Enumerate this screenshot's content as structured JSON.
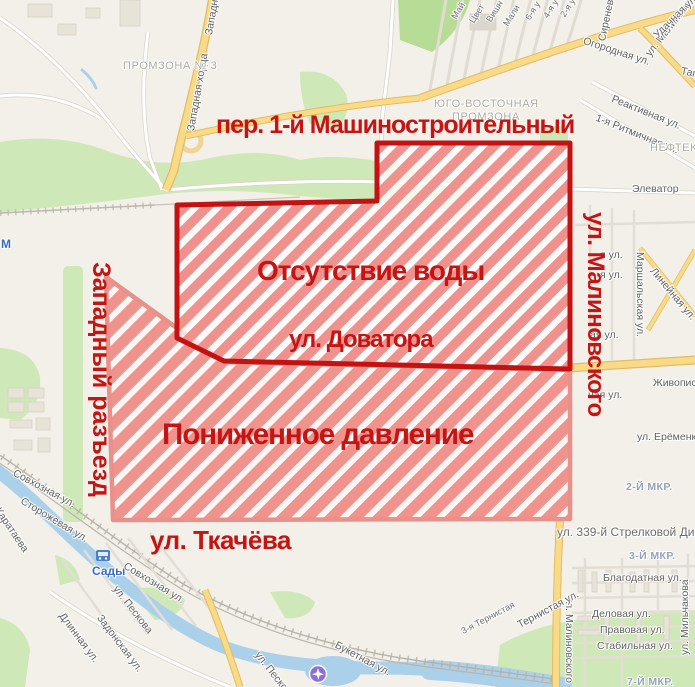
{
  "app": {
    "title": "Карта отключений воды"
  },
  "overlay": {
    "label_color": "#c51414",
    "hatch_color": "#ef928e",
    "zones": [
      {
        "name": "low-pressure-zone",
        "title": "Пониженное давление",
        "points": "106,277 224,362 570,370 570,519 113,520",
        "base_fill": "rgba(255,247,246,0.80)",
        "pattern": "hatchB",
        "border_color": "#e8908a",
        "border_width": 4.5
      },
      {
        "name": "no-water-zone",
        "title": "Отсутствие воды",
        "points": "177,205 377,201 377,143 570,143 570,369 224,361 177,338",
        "base_fill": "rgba(255,255,255,0.74)",
        "pattern": "hatchA",
        "border_color": "#c41212",
        "border_width": 5
      }
    ],
    "labels": [
      {
        "name": "overlay-street-mashinostroitelny",
        "text": "пер. 1-й Машиностроительный",
        "x": 216,
        "y": 112,
        "size": 25,
        "rot": 0,
        "ls": -1
      },
      {
        "name": "overlay-street-malinovskogo",
        "text": "ул. Малиновского",
        "x": 608,
        "y": 212,
        "size": 24,
        "rot": 90,
        "ls": -0.5
      },
      {
        "name": "zone-label-no-water",
        "text": "Отсутствие воды",
        "x": 257,
        "y": 256,
        "size": 28,
        "rot": 0,
        "ls": -1
      },
      {
        "name": "overlay-street-dovatora",
        "text": "ул. Доватора",
        "x": 289,
        "y": 327,
        "size": 24,
        "rot": 0,
        "ls": -1
      },
      {
        "name": "zone-label-low-pressure",
        "text": "Пониженное давление",
        "x": 162,
        "y": 420,
        "size": 29.5,
        "rot": 0,
        "ls": -1
      },
      {
        "name": "overlay-street-zapadny-razezd",
        "text": "Западный разъезд",
        "x": 114,
        "y": 262,
        "size": 25,
        "rot": 90,
        "ls": 0
      },
      {
        "name": "overlay-street-tkacheva",
        "text": "ул. Ткачёва",
        "x": 150,
        "y": 527,
        "size": 26,
        "rot": 0,
        "ls": -0.5
      }
    ]
  },
  "map_labels": [
    {
      "text": "Западная хорда",
      "x": 186,
      "y": 130,
      "rot": -80,
      "cls": "street"
    },
    {
      "text": "Западная хорда",
      "x": 204,
      "y": 34,
      "rot": -80,
      "cls": "street"
    },
    {
      "text": "ПРОМЗОНА № 3",
      "x": 123,
      "y": 60,
      "rot": 0,
      "cls": "area"
    },
    {
      "text": "ЮГО-ВОСТОЧНАЯ",
      "x": 434,
      "y": 98,
      "rot": 0,
      "cls": "area"
    },
    {
      "text": "ПРОМЗОНА",
      "x": 452,
      "y": 111,
      "rot": 0,
      "cls": "area"
    },
    {
      "text": "Огородная ул.",
      "x": 585,
      "y": 36,
      "rot": 18,
      "cls": "street"
    },
    {
      "text": "ул. Малиновского",
      "x": 644,
      "y": 52,
      "rot": -52,
      "cls": "street"
    },
    {
      "text": "Сиреневая ул.",
      "x": 597,
      "y": 40,
      "rot": -78,
      "cls": "street"
    },
    {
      "text": "Удачная ул.",
      "x": 652,
      "y": 33,
      "rot": -45,
      "cls": "street"
    },
    {
      "text": "Таг",
      "x": 682,
      "y": 66,
      "rot": 12,
      "cls": "street"
    },
    {
      "text": "Реактивная ул.",
      "x": 614,
      "y": 94,
      "rot": 22,
      "cls": "street"
    },
    {
      "text": "1-я Ритмичная ул.",
      "x": 598,
      "y": 113,
      "rot": 22,
      "cls": "street"
    },
    {
      "text": "Май",
      "x": 450,
      "y": 16,
      "rot": -58,
      "cls": "small"
    },
    {
      "text": "Цвет",
      "x": 468,
      "y": 20,
      "rot": -58,
      "cls": "small"
    },
    {
      "text": "Вишн",
      "x": 485,
      "y": 19,
      "rot": -58,
      "cls": "small"
    },
    {
      "text": "Мали",
      "x": 502,
      "y": 23,
      "rot": -58,
      "cls": "small"
    },
    {
      "text": "6-я у",
      "x": 524,
      "y": 17,
      "rot": -58,
      "cls": "small"
    },
    {
      "text": "4-я у",
      "x": 542,
      "y": 15,
      "rot": -58,
      "cls": "small"
    },
    {
      "text": "2-я у",
      "x": 559,
      "y": 14,
      "rot": -58,
      "cls": "small"
    },
    {
      "text": "НЕФТЕКАЧ",
      "x": 650,
      "y": 142,
      "rot": 0,
      "cls": "area"
    },
    {
      "text": "Элеватор",
      "x": 632,
      "y": 184,
      "rot": 0,
      "cls": "street"
    },
    {
      "text": "Маршальская ул.",
      "x": 645,
      "y": 252,
      "rot": 90,
      "cls": "street"
    },
    {
      "text": "Линейная ул.",
      "x": 656,
      "y": 266,
      "rot": 50,
      "cls": "street"
    },
    {
      "text": "я ул.",
      "x": 600,
      "y": 250,
      "rot": 0,
      "cls": "street"
    },
    {
      "text": "я ул.",
      "x": 600,
      "y": 270,
      "rot": 0,
      "cls": "street"
    },
    {
      "text": "ая ул.",
      "x": 590,
      "y": 330,
      "rot": 0,
      "cls": "street"
    },
    {
      "text": "ная ул.",
      "x": 588,
      "y": 390,
      "rot": 0,
      "cls": "street"
    },
    {
      "text": "Живописная ул.",
      "x": 653,
      "y": 378,
      "rot": 0,
      "cls": "street"
    },
    {
      "text": "ул. Ерёменко",
      "x": 637,
      "y": 432,
      "rot": 0,
      "cls": "street"
    },
    {
      "text": "2-Й МКР.",
      "x": 626,
      "y": 482,
      "rot": 0,
      "cls": "mkr"
    },
    {
      "text": "ул. 339-й Стрелковой Дивизии",
      "x": 557,
      "y": 526,
      "rot": 0,
      "cls": "street-lg"
    },
    {
      "text": "3-Й МКР.",
      "x": 629,
      "y": 551,
      "rot": 0,
      "cls": "mkr"
    },
    {
      "text": "Благодатная ул.",
      "x": 603,
      "y": 573,
      "rot": 0,
      "cls": "street"
    },
    {
      "text": "Деловая ул.",
      "x": 592,
      "y": 609,
      "rot": 0,
      "cls": "street"
    },
    {
      "text": "Правовая ул.",
      "x": 600,
      "y": 625,
      "rot": 0,
      "cls": "street"
    },
    {
      "text": "Стабильная ул.",
      "x": 597,
      "y": 641,
      "rot": 0,
      "cls": "street"
    },
    {
      "text": "7-Й МКР.",
      "x": 627,
      "y": 677,
      "rot": 0,
      "cls": "mkr"
    },
    {
      "text": "ул. Малиновского",
      "x": 574,
      "y": 597,
      "rot": 90,
      "cls": "street"
    },
    {
      "text": "ул. Мильчакова",
      "x": 680,
      "y": 655,
      "rot": -90,
      "cls": "street"
    },
    {
      "text": "Тернистая ул.",
      "x": 516,
      "y": 621,
      "rot": -28,
      "cls": "street"
    },
    {
      "text": "3-я Тернистая",
      "x": 460,
      "y": 628,
      "rot": -28,
      "cls": "small"
    },
    {
      "text": "Букетная ул.",
      "x": 338,
      "y": 640,
      "rot": 28,
      "cls": "street"
    },
    {
      "text": "ул. Пескова",
      "x": 261,
      "y": 650,
      "rot": 52,
      "cls": "street"
    },
    {
      "text": "Совхозная ул.",
      "x": 16,
      "y": 468,
      "rot": 28,
      "cls": "street"
    },
    {
      "text": "Сторожевая ул.",
      "x": 24,
      "y": 496,
      "rot": 31,
      "cls": "street"
    },
    {
      "text": "ул. Каратаева",
      "x": -8,
      "y": 492,
      "rot": 56,
      "cls": "street"
    },
    {
      "text": "Сады",
      "x": 92,
      "y": 565,
      "rot": 0,
      "cls": "station"
    },
    {
      "text": "Совхозная ул.",
      "x": 127,
      "y": 561,
      "rot": 31,
      "cls": "street"
    },
    {
      "text": "ул. Пескова",
      "x": 119,
      "y": 584,
      "rot": 52,
      "cls": "street"
    },
    {
      "text": "Задонская ул.",
      "x": 103,
      "y": 613,
      "rot": 53,
      "cls": "street"
    },
    {
      "text": "Длинная ул.",
      "x": 65,
      "y": 611,
      "rot": 53,
      "cls": "street"
    },
    {
      "text": "М",
      "x": 1,
      "y": 238,
      "rot": 0,
      "cls": "station"
    }
  ]
}
